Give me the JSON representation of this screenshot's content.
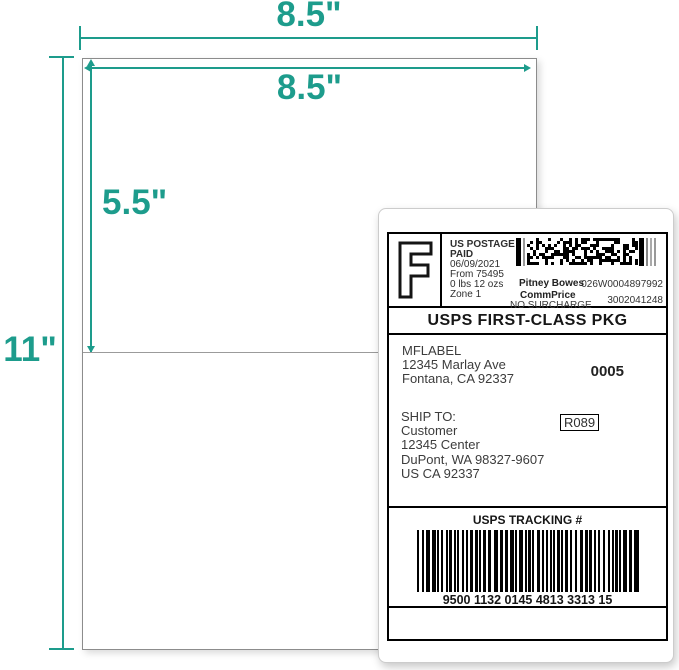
{
  "colors": {
    "accent": "#1d9c8c",
    "sheet_border": "#8c8c8c",
    "perforation": "#9b9b9b"
  },
  "dimension_labels": {
    "sheet_width": "8.5\"",
    "label_width": "8.5\"",
    "label_height": "5.5\"",
    "sheet_height": "11\""
  },
  "shipping_label": {
    "postage": {
      "indicia_letter": "F",
      "lines": [
        "US POSTAGE",
        "PAID",
        "06/09/2021",
        "From 75495",
        "0 lbs 12 ozs",
        "Zone 1"
      ],
      "carrier": "Pitney Bowes",
      "meter_id": "026W0004897992",
      "rate_type": "CommPrice",
      "surcharge": "NO SURCHARGE",
      "account_id": "3002041248"
    },
    "service": "USPS FIRST-CLASS PKG",
    "sender": {
      "lines": [
        "MFLABEL",
        "12345 Marlay Ave",
        "Fontana, CA 92337"
      ],
      "batch_code": "0005"
    },
    "recipient": {
      "heading": "SHIP TO:",
      "lines": [
        "Customer",
        "12345 Center",
        "DuPont, WA 98327-9607",
        "US CA 92337"
      ],
      "route_code": "R089"
    },
    "tracking": {
      "heading": "USPS TRACKING #",
      "number": "9500 1132 0145 4813 3313 15"
    }
  }
}
